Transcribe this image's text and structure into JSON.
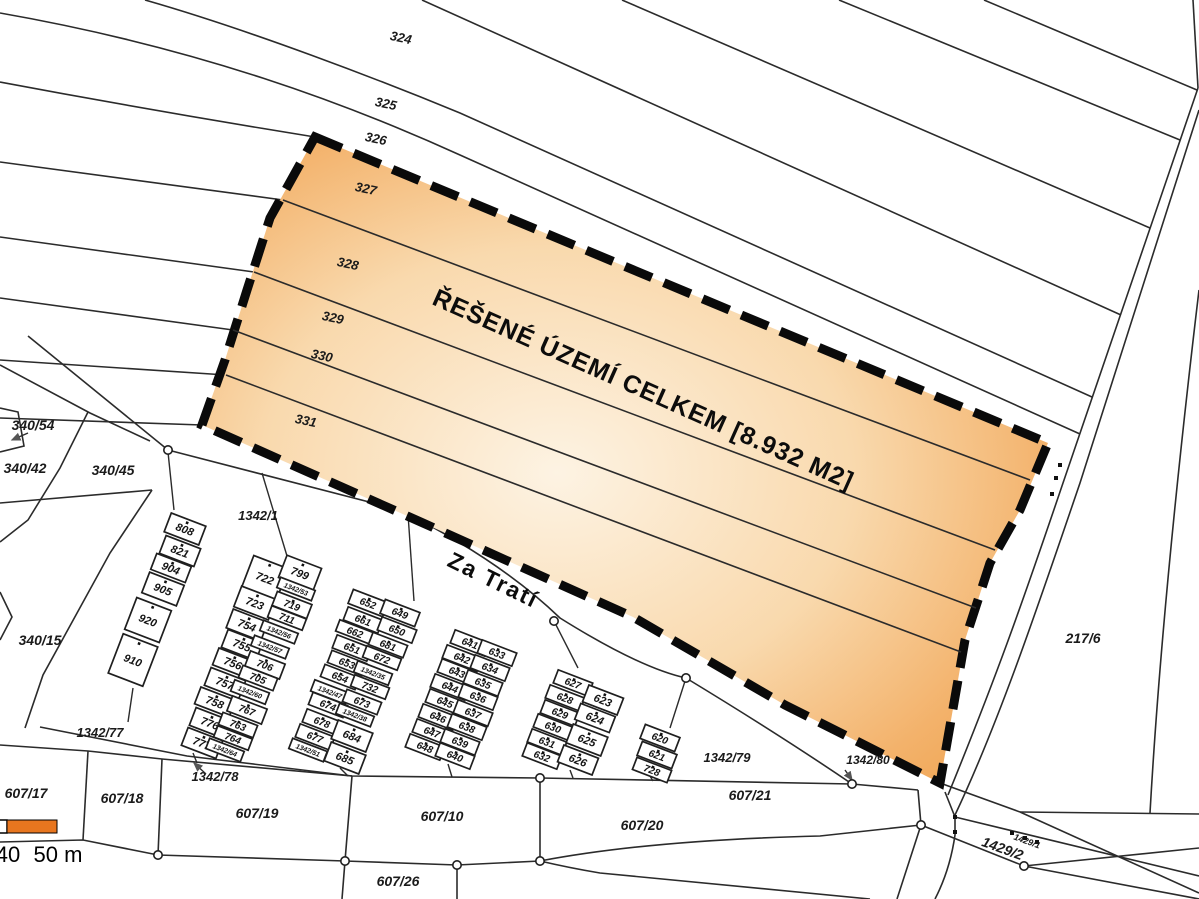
{
  "map": {
    "area_label": {
      "text": "ŘEŠENÉ ÚZEMÍ CELKEM [8.932 M2]",
      "x": 640,
      "y": 397,
      "rot": 24,
      "size": 25
    },
    "street": {
      "text": "Za Tratí",
      "x": 490,
      "y": 587,
      "rot": 26,
      "size": 23
    },
    "colors": {
      "boundary_dash": "#0a0a0a",
      "line": "#2b2b2b",
      "area_edge": "#ee9c42",
      "area_mid": "#f3b26b",
      "area_center": "#fdf3e3",
      "scale_orange": "#e8761f"
    },
    "scale_bar": {
      "labels": [
        "40",
        "50 m"
      ]
    },
    "strip_labels": [
      {
        "t": "324",
        "x": 400,
        "y": 42
      },
      {
        "t": "325",
        "x": 385,
        "y": 108
      },
      {
        "t": "326",
        "x": 375,
        "y": 143
      },
      {
        "t": "327",
        "x": 365,
        "y": 193
      },
      {
        "t": "328",
        "x": 347,
        "y": 268
      },
      {
        "t": "329",
        "x": 332,
        "y": 322
      },
      {
        "t": "330",
        "x": 321,
        "y": 360
      },
      {
        "t": "331",
        "x": 305,
        "y": 425
      }
    ],
    "parcel_labels": [
      {
        "t": "340/54",
        "x": 33,
        "y": 430,
        "fs": 14
      },
      {
        "t": "340/42",
        "x": 25,
        "y": 473,
        "fs": 14
      },
      {
        "t": "340/45",
        "x": 113,
        "y": 475,
        "fs": 14
      },
      {
        "t": "340/15",
        "x": 40,
        "y": 645,
        "fs": 14
      },
      {
        "t": "1342/1",
        "x": 258,
        "y": 520,
        "fs": 13
      },
      {
        "t": "1342/77",
        "x": 100,
        "y": 737,
        "fs": 13
      },
      {
        "t": "1342/78",
        "x": 215,
        "y": 781,
        "fs": 13
      },
      {
        "t": "1342/79",
        "x": 727,
        "y": 762,
        "fs": 13
      },
      {
        "t": "1342/80",
        "x": 868,
        "y": 764,
        "fs": 12
      },
      {
        "t": "607/17",
        "x": 26,
        "y": 798,
        "fs": 14
      },
      {
        "t": "607/18",
        "x": 122,
        "y": 803,
        "fs": 14
      },
      {
        "t": "607/19",
        "x": 257,
        "y": 818,
        "fs": 14
      },
      {
        "t": "607/10",
        "x": 442,
        "y": 821,
        "fs": 14
      },
      {
        "t": "607/20",
        "x": 642,
        "y": 830,
        "fs": 14
      },
      {
        "t": "607/21",
        "x": 750,
        "y": 800,
        "fs": 14
      },
      {
        "t": "607/26",
        "x": 398,
        "y": 886,
        "fs": 14
      },
      {
        "t": "217/6",
        "x": 1083,
        "y": 643,
        "fs": 14
      },
      {
        "t": "1429/1",
        "x": 1026,
        "y": 844,
        "fs": 9,
        "rot": 20
      },
      {
        "t": "1429/2",
        "x": 1001,
        "y": 853,
        "fs": 14,
        "rot": 20
      }
    ],
    "grid_cells": [
      {
        "t": "808",
        "x": 185,
        "y": 529,
        "h": 20
      },
      {
        "t": "821",
        "x": 180,
        "y": 551,
        "h": 19
      },
      {
        "t": "904",
        "x": 171,
        "y": 568,
        "h": 17
      },
      {
        "t": "905",
        "x": 163,
        "y": 589,
        "h": 22
      },
      {
        "t": "920",
        "x": 148,
        "y": 620,
        "h": 34
      },
      {
        "t": "910",
        "x": 133,
        "y": 660,
        "h": 42
      },
      {
        "t": "722",
        "x": 265,
        "y": 578,
        "h": 34
      },
      {
        "t": "723",
        "x": 255,
        "y": 603,
        "h": 22
      },
      {
        "t": "754",
        "x": 247,
        "y": 625,
        "h": 20
      },
      {
        "t": "755",
        "x": 242,
        "y": 645,
        "h": 19
      },
      {
        "t": "756",
        "x": 233,
        "y": 663,
        "h": 18
      },
      {
        "t": "757",
        "x": 225,
        "y": 683,
        "h": 19
      },
      {
        "t": "758",
        "x": 215,
        "y": 702,
        "h": 18
      },
      {
        "t": "776",
        "x": 210,
        "y": 723,
        "h": 19
      },
      {
        "t": "777",
        "x": 202,
        "y": 743,
        "h": 19
      },
      {
        "t": "799",
        "x": 300,
        "y": 573,
        "h": 24
      },
      {
        "t": "1342/53",
        "x": 296,
        "y": 589,
        "h": 11
      },
      {
        "t": "719",
        "x": 292,
        "y": 605,
        "h": 15
      },
      {
        "t": "711",
        "x": 287,
        "y": 618,
        "h": 12
      },
      {
        "t": "1342/56",
        "x": 279,
        "y": 632,
        "h": 11
      },
      {
        "t": "1342/57",
        "x": 270,
        "y": 647,
        "h": 11
      },
      {
        "t": "706",
        "x": 265,
        "y": 665,
        "h": 16
      },
      {
        "t": "705",
        "x": 258,
        "y": 678,
        "h": 13
      },
      {
        "t": "1342/60",
        "x": 250,
        "y": 692,
        "h": 12
      },
      {
        "t": "767",
        "x": 247,
        "y": 710,
        "h": 16
      },
      {
        "t": "763",
        "x": 238,
        "y": 725,
        "h": 13
      },
      {
        "t": "764",
        "x": 233,
        "y": 738,
        "h": 12
      },
      {
        "t": "1342/64",
        "x": 225,
        "y": 750,
        "h": 11
      },
      {
        "t": "652",
        "x": 368,
        "y": 603,
        "h": 15
      },
      {
        "t": "661",
        "x": 363,
        "y": 620,
        "h": 14
      },
      {
        "t": "662",
        "x": 355,
        "y": 632,
        "h": 12
      },
      {
        "t": "651",
        "x": 352,
        "y": 648,
        "h": 14
      },
      {
        "t": "653",
        "x": 347,
        "y": 663,
        "h": 13
      },
      {
        "t": "654",
        "x": 340,
        "y": 677,
        "h": 13
      },
      {
        "t": "1342/47",
        "x": 330,
        "y": 692,
        "h": 12
      },
      {
        "t": "674",
        "x": 328,
        "y": 705,
        "h": 13
      },
      {
        "t": "678",
        "x": 322,
        "y": 722,
        "h": 14
      },
      {
        "t": "677",
        "x": 315,
        "y": 737,
        "h": 14
      },
      {
        "t": "1342/51",
        "x": 308,
        "y": 750,
        "h": 11
      },
      {
        "t": "649",
        "x": 400,
        "y": 613,
        "h": 15
      },
      {
        "t": "650",
        "x": 397,
        "y": 630,
        "h": 14
      },
      {
        "t": "681",
        "x": 388,
        "y": 645,
        "h": 13
      },
      {
        "t": "672",
        "x": 382,
        "y": 658,
        "h": 12
      },
      {
        "t": "1342/35",
        "x": 373,
        "y": 673,
        "h": 12
      },
      {
        "t": "732",
        "x": 370,
        "y": 687,
        "h": 12
      },
      {
        "t": "673",
        "x": 362,
        "y": 702,
        "h": 13
      },
      {
        "t": "1342/38",
        "x": 355,
        "y": 715,
        "h": 11
      },
      {
        "t": "684",
        "x": 352,
        "y": 736,
        "h": 20
      },
      {
        "t": "685",
        "x": 345,
        "y": 758,
        "h": 20
      },
      {
        "t": "641",
        "x": 470,
        "y": 643,
        "h": 14
      },
      {
        "t": "642",
        "x": 462,
        "y": 658,
        "h": 14
      },
      {
        "t": "643",
        "x": 457,
        "y": 672,
        "h": 14
      },
      {
        "t": "644",
        "x": 450,
        "y": 687,
        "h": 14
      },
      {
        "t": "645",
        "x": 445,
        "y": 702,
        "h": 14
      },
      {
        "t": "646",
        "x": 438,
        "y": 717,
        "h": 14
      },
      {
        "t": "647",
        "x": 432,
        "y": 732,
        "h": 14
      },
      {
        "t": "648",
        "x": 425,
        "y": 747,
        "h": 14
      },
      {
        "t": "633",
        "x": 497,
        "y": 653,
        "h": 14
      },
      {
        "t": "634",
        "x": 490,
        "y": 668,
        "h": 14
      },
      {
        "t": "635",
        "x": 483,
        "y": 683,
        "h": 14
      },
      {
        "t": "636",
        "x": 478,
        "y": 697,
        "h": 14
      },
      {
        "t": "637",
        "x": 473,
        "y": 713,
        "h": 14
      },
      {
        "t": "638",
        "x": 467,
        "y": 727,
        "h": 14
      },
      {
        "t": "639",
        "x": 460,
        "y": 742,
        "h": 14
      },
      {
        "t": "640",
        "x": 455,
        "y": 756,
        "h": 14
      },
      {
        "t": "627",
        "x": 573,
        "y": 683,
        "h": 14
      },
      {
        "t": "628",
        "x": 565,
        "y": 698,
        "h": 14
      },
      {
        "t": "629",
        "x": 560,
        "y": 713,
        "h": 14
      },
      {
        "t": "630",
        "x": 553,
        "y": 727,
        "h": 14
      },
      {
        "t": "631",
        "x": 547,
        "y": 742,
        "h": 14
      },
      {
        "t": "632",
        "x": 542,
        "y": 756,
        "h": 14
      },
      {
        "t": "623",
        "x": 603,
        "y": 700,
        "h": 18
      },
      {
        "t": "624",
        "x": 595,
        "y": 718,
        "h": 17
      },
      {
        "t": "625",
        "x": 587,
        "y": 740,
        "h": 20
      },
      {
        "t": "626",
        "x": 578,
        "y": 760,
        "h": 18
      },
      {
        "t": "620",
        "x": 660,
        "y": 738,
        "h": 15
      },
      {
        "t": "621",
        "x": 657,
        "y": 755,
        "h": 15
      },
      {
        "t": "728",
        "x": 652,
        "y": 770,
        "h": 13
      }
    ]
  }
}
